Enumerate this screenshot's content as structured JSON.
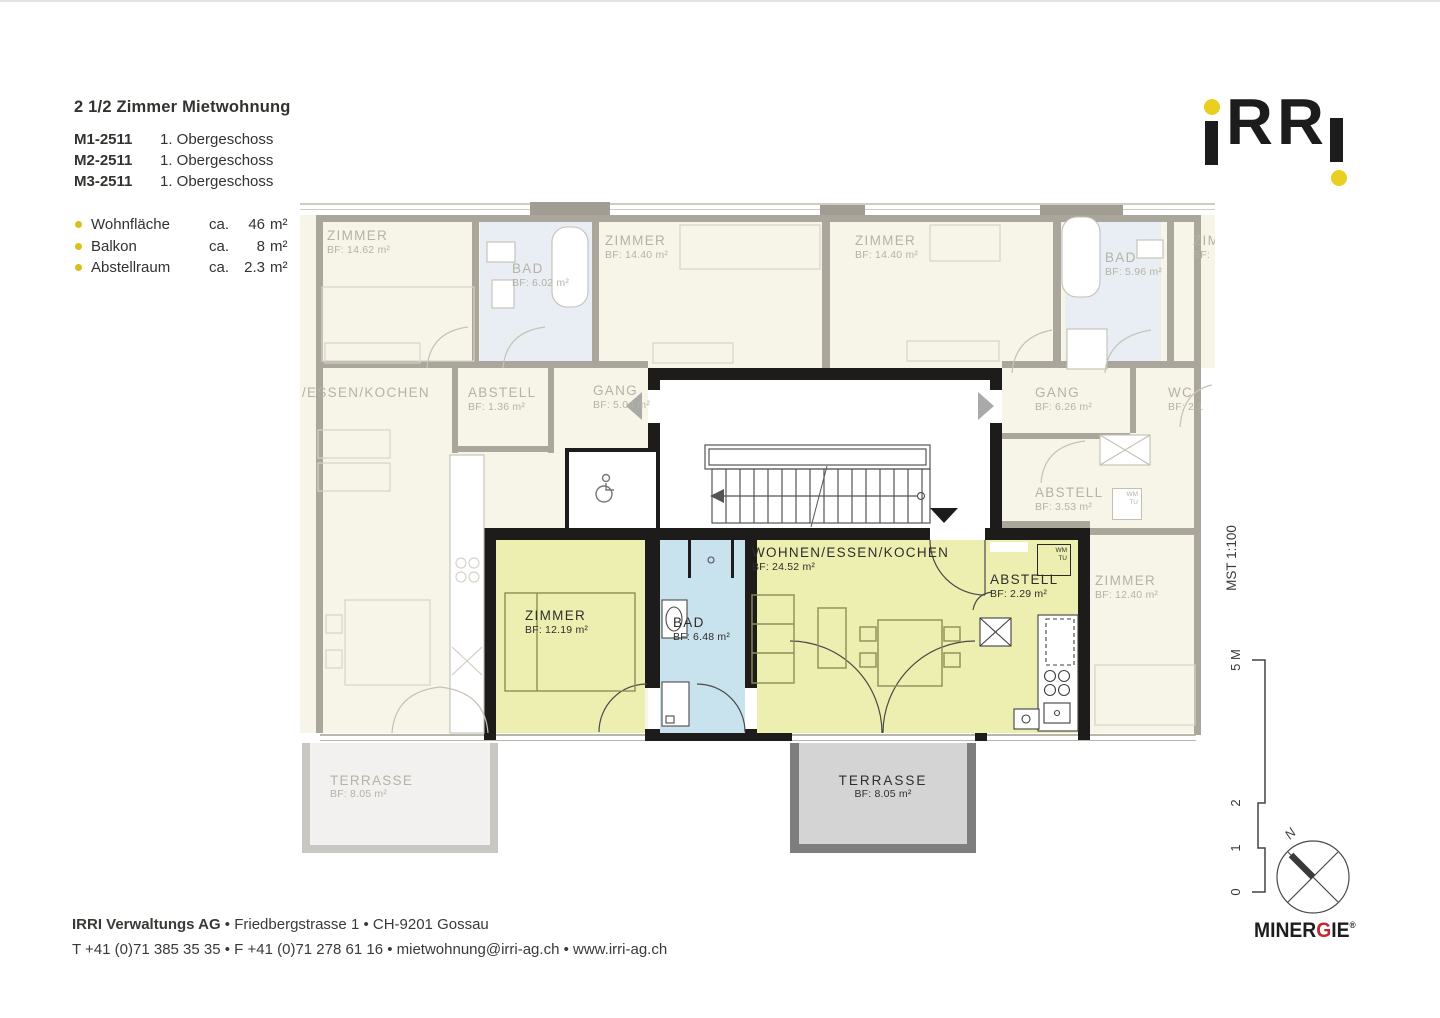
{
  "header": {
    "title": "2 1/2 Zimmer Mietwohnung",
    "units": [
      {
        "code": "M1-2511",
        "floor": "1. Obergeschoss"
      },
      {
        "code": "M2-2511",
        "floor": "1. Obergeschoss"
      },
      {
        "code": "M3-2511",
        "floor": "1. Obergeschoss"
      }
    ],
    "specs": [
      {
        "label": "Wohnfläche",
        "ca": "ca.",
        "num": "46",
        "unit": "m²"
      },
      {
        "label": "Balkon",
        "ca": "ca.",
        "num": "8",
        "unit": "m²"
      },
      {
        "label": "Abstellraum",
        "ca": "ca.",
        "num": "2.3",
        "unit": "m²"
      }
    ]
  },
  "logo": {
    "letters": "RR"
  },
  "plan": {
    "rooms": {
      "zimmer": {
        "name": "ZIMMER",
        "bf": "BF: 12.19 m²"
      },
      "bad": {
        "name": "BAD",
        "bf": "BF: 6.48 m²"
      },
      "wohnen": {
        "name": "WOHNEN/ESSEN/KOCHEN",
        "bf": "BF: 24.52 m²"
      },
      "abstell": {
        "name": "ABSTELL",
        "bf": "BF: 2.29 m²"
      },
      "terrasse": {
        "name": "TERRASSE",
        "bf": "BF: 8.05 m²"
      }
    },
    "bg": {
      "zimmer_tl": {
        "name": "ZIMMER",
        "bf": "BF: 14.62 m²"
      },
      "bad_tl": {
        "name": "BAD",
        "bf": "BF: 6.02 m²"
      },
      "zimmer_tm": {
        "name": "ZIMMER",
        "bf": "BF: 14.40 m²"
      },
      "zimmer_tr": {
        "name": "ZIMMER",
        "bf": "BF: 14.40 m²"
      },
      "bad_tr": {
        "name": "BAD",
        "bf": "BF: 5.96 m²"
      },
      "zimmer_edge": {
        "name": "ZIMMER",
        "bf": "BF:"
      },
      "essen_kochen": {
        "name": "/ESSEN/KOCHEN"
      },
      "abstell_l": {
        "name": "ABSTELL",
        "bf": "BF: 1.36 m²"
      },
      "gang_l": {
        "name": "GANG",
        "bf": "BF: 5.04 m²"
      },
      "gang_r": {
        "name": "GANG",
        "bf": "BF: 6.26 m²"
      },
      "wc": {
        "name": "WC",
        "bf": "BF: 2.1"
      },
      "abstell_r": {
        "name": "ABSTELL",
        "bf": "BF: 3.53 m²"
      },
      "zimmer_r": {
        "name": "ZIMMER",
        "bf": "BF: 12.40 m²"
      },
      "terrasse_l": {
        "name": "TERRASSE",
        "bf": "BF: 8.05 m²"
      }
    },
    "wm": "WM",
    "tu": "TU"
  },
  "sidebar": {
    "mst": "MST 1:100",
    "tick0": "0",
    "tick1": "1",
    "tick2": "2",
    "tick5": "5 M",
    "north": "N"
  },
  "minergie": {
    "p1": "MINER",
    "p2": "G",
    "p3": "IE",
    "reg": "®"
  },
  "footer": {
    "company": "IRRI Verwaltungs AG",
    "address": " • Friedbergstrasse 1 • CH-9201 Gossau",
    "line2": "T +41 (0)71 385 35 35 • F +41 (0)71 278 61 16 • mietwohnung@irri-ag.ch • www.irri-ag.ch"
  },
  "colors": {
    "accent_yellow": "#e9d020",
    "minergie_red": "#c62832",
    "room_yellow": "#edefb0",
    "room_blue": "#c9e3ee"
  }
}
